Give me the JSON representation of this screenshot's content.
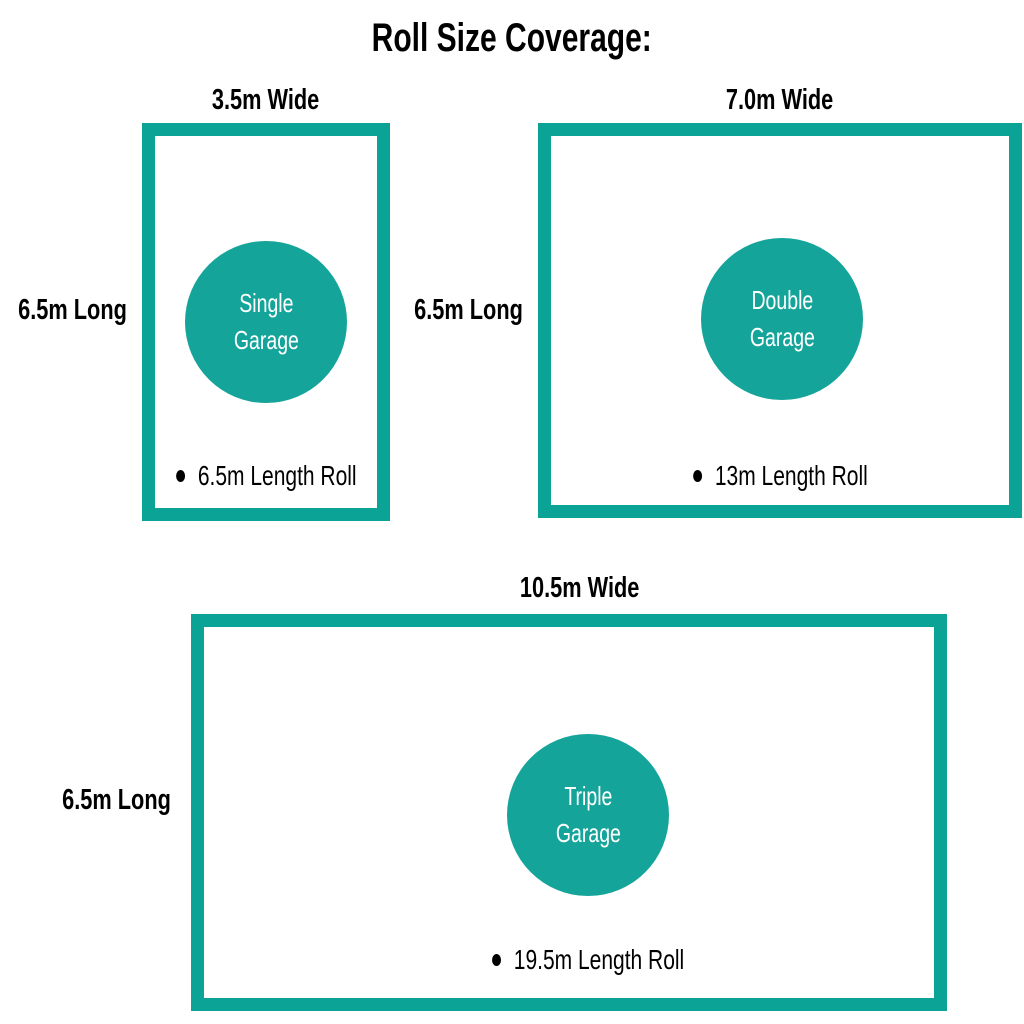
{
  "title": "Roll Size Coverage:",
  "colors": {
    "teal_border": "#0aa396",
    "teal_circle": "#14a49a",
    "text": "#000000",
    "circle_text": "#ffffff"
  },
  "panels": [
    {
      "width_label": "3.5m Wide",
      "length_label": "6.5m Long",
      "garage_line1": "Single",
      "garage_line2": "Garage",
      "roll_label": "6.5m Length Roll"
    },
    {
      "width_label": "7.0m Wide",
      "length_label": "6.5m Long",
      "garage_line1": "Double",
      "garage_line2": "Garage",
      "roll_label": "13m Length Roll"
    },
    {
      "width_label": "10.5m Wide",
      "length_label": "6.5m Long",
      "garage_line1": "Triple",
      "garage_line2": "Garage",
      "roll_label": "19.5m Length Roll"
    }
  ]
}
